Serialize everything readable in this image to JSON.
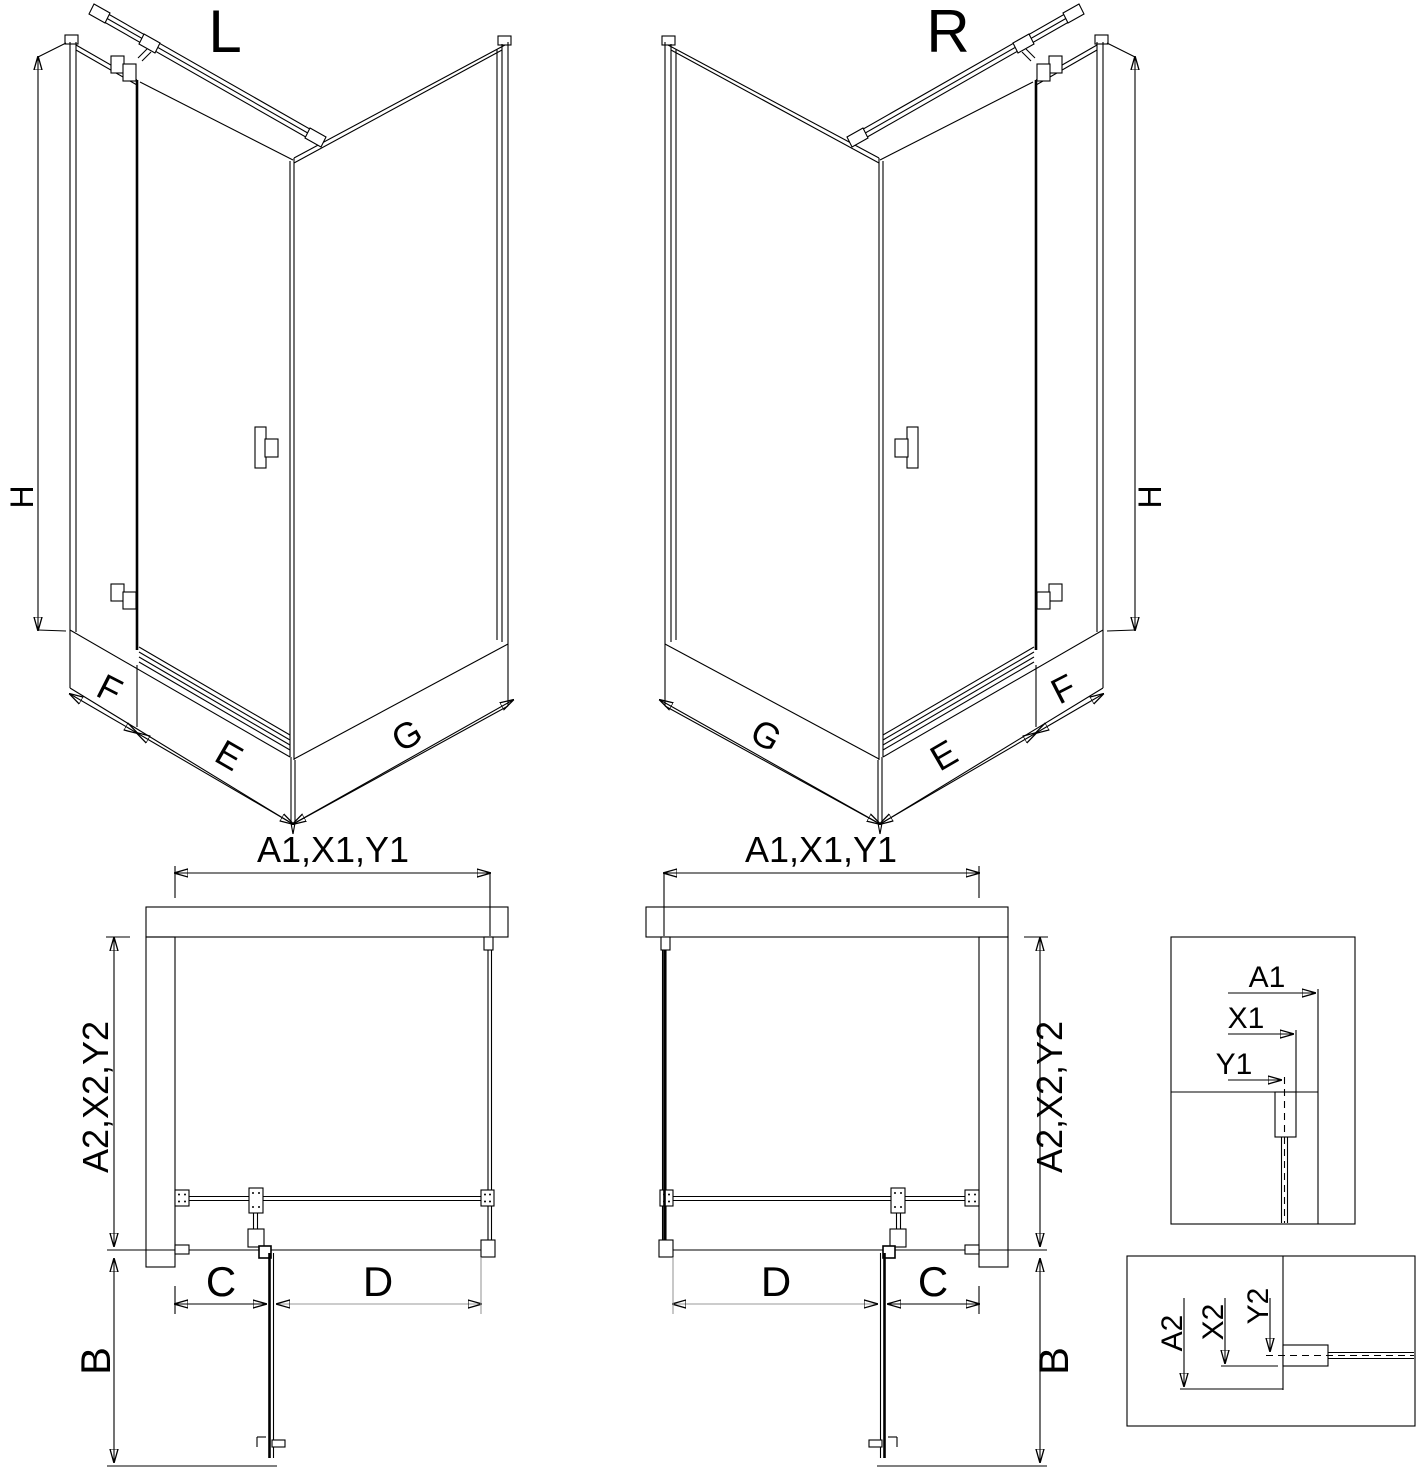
{
  "variants": {
    "left": {
      "title": "L"
    },
    "right": {
      "title": "R"
    }
  },
  "dims": {
    "height": "H",
    "front_fixed": "F",
    "door_panel": "E",
    "side_panel": "G",
    "width_top": "A1,X1,Y1",
    "depth_side": "A2,X2,Y2",
    "segment_c": "C",
    "segment_d": "D",
    "swing_b": "B"
  },
  "detail_top": {
    "a1": "A1",
    "x1": "X1",
    "y1": "Y1"
  },
  "detail_bottom": {
    "a2": "A2",
    "x2": "X2",
    "y2": "Y2"
  },
  "colors": {
    "line": "#000000",
    "secondary_dimension": "#9a9a9a",
    "background": "#ffffff"
  }
}
